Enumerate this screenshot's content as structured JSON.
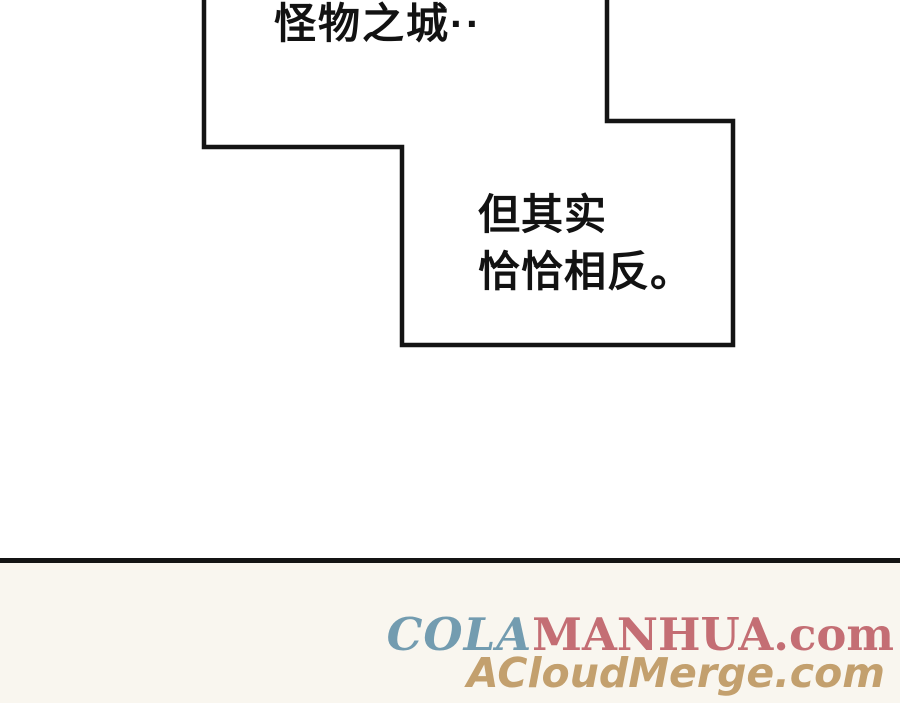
{
  "bubble1": {
    "text": "怪物之城··"
  },
  "bubble2": {
    "line1": "但其实",
    "line2": "恰恰相反。"
  },
  "outline": {
    "stroke_color": "#141414",
    "fill_color": "#ffffff",
    "stroke_width": 4.5
  },
  "divider": {
    "color": "#141414"
  },
  "footer": {
    "background": "#f9f6ef",
    "watermark1": {
      "cola": "COLA",
      "cola_color": "#739cb0",
      "manhua": "MANHUA.com",
      "manhua_color": "#c46e74"
    },
    "watermark2": {
      "text": "ACloudMerge.com",
      "color": "#c3a06e"
    }
  }
}
